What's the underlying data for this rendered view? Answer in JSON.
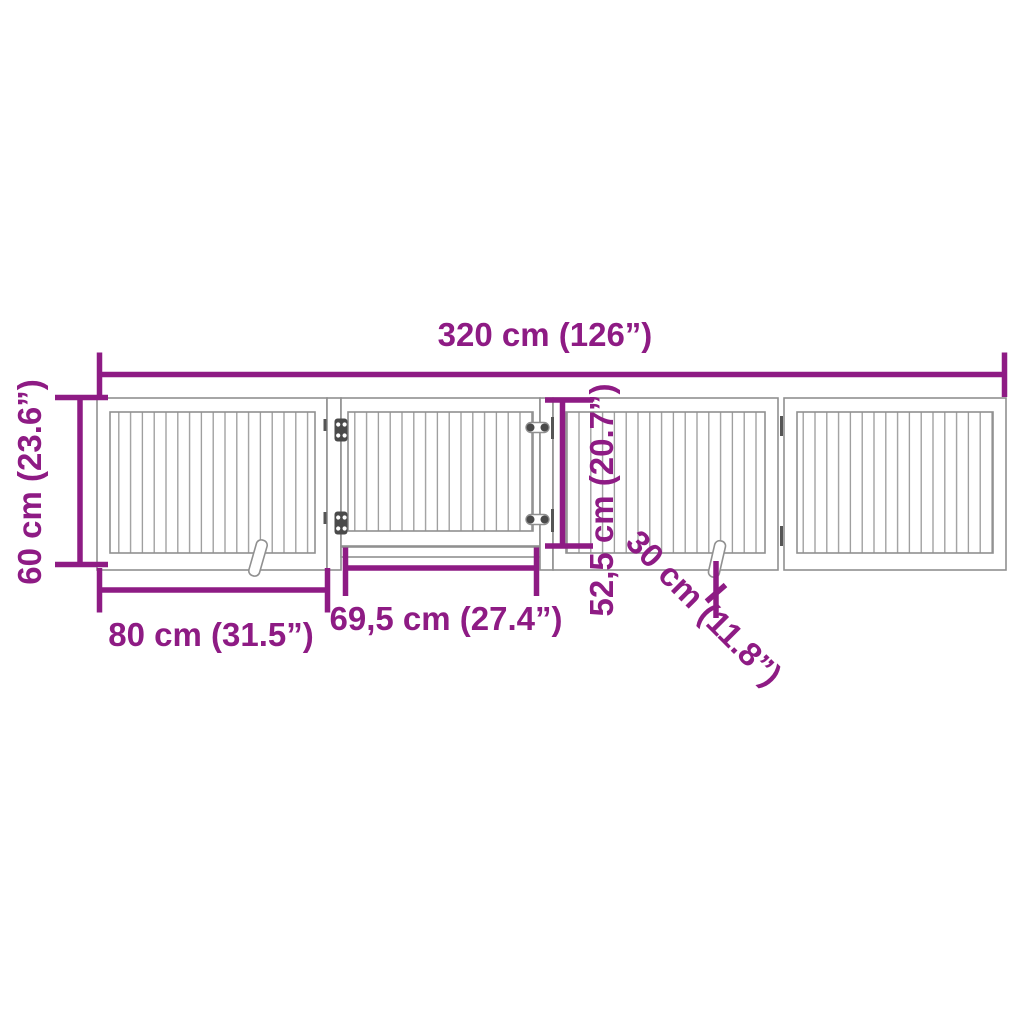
{
  "page": {
    "background_color": "#ffffff"
  },
  "diagram": {
    "accent_color": "#8e1b84",
    "line_color": "#909090",
    "hardware_color": "#4a4a4a",
    "labels": {
      "total_width": "320 cm (126”)",
      "gate_height": "60 cm (23.6”)",
      "panel_width": "80 cm (31.5”)",
      "door_width": "69,5 cm (27.4”)",
      "door_height": "52,5 cm (20.7”)",
      "foot_length": "30 cm (11.8”)"
    }
  }
}
